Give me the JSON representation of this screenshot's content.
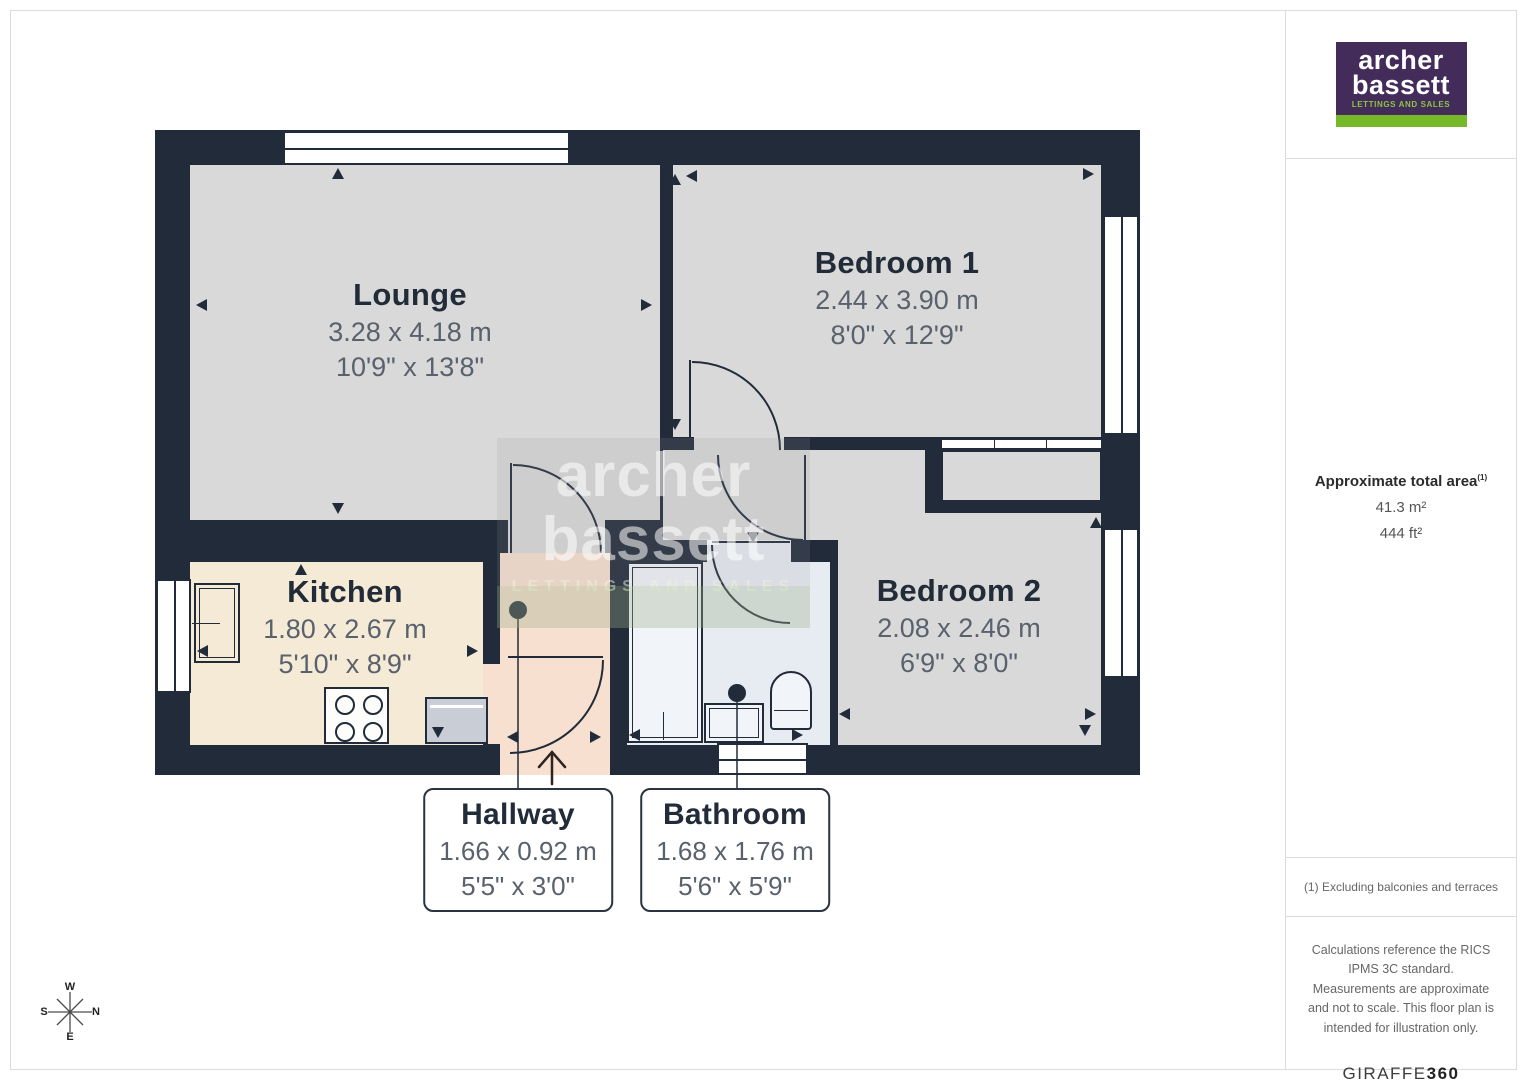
{
  "plan": {
    "rooms": [
      {
        "name": "Lounge",
        "metric": "3.28 x 4.18 m",
        "imperial": "10'9\" x 13'8\""
      },
      {
        "name": "Bedroom 1",
        "metric": "2.44 x 3.90 m",
        "imperial": "8'0\" x 12'9\""
      },
      {
        "name": "Kitchen",
        "metric": "1.80 x 2.67 m",
        "imperial": "5'10\" x 8'9\""
      },
      {
        "name": "Bedroom 2",
        "metric": "2.08 x 2.46 m",
        "imperial": "6'9\" x 8'0\""
      },
      {
        "name": "Hallway",
        "metric": "1.66 x 0.92 m",
        "imperial": "5'5\" x 3'0\""
      },
      {
        "name": "Bathroom",
        "metric": "1.68 x 1.76 m",
        "imperial": "5'6\" x 5'9\""
      }
    ],
    "watermark": {
      "line1": "archer",
      "line2": "bassett",
      "tagline": "LETTINGS AND SALES"
    },
    "compass": {
      "top": "W",
      "right": "N",
      "bottom": "E",
      "left": "S"
    }
  },
  "sidebar": {
    "logo": {
      "line1": "archer",
      "line2": "bassett",
      "tagline": "LETTINGS AND SALES"
    },
    "area": {
      "title": "Approximate total area",
      "footnote_ref": "(1)",
      "metric": "41.3 m²",
      "imperial": "444 ft²"
    },
    "footnote": "(1) Excluding balconies and terraces",
    "disclaimer": "Calculations reference the RICS IPMS 3C standard. Measurements are approximate and not to scale. This floor plan is intended for illustration only.",
    "provider": {
      "name": "GIRAFFE",
      "suffix": "360"
    }
  },
  "colors": {
    "wall": "#212b39",
    "room_gray": "#d9d9d9",
    "kitchen": "#f4ead6",
    "hallway": "#f8e0d0",
    "bathroom": "#e7ebf2",
    "logo_purple": "#432c5a",
    "logo_green": "#76b82a",
    "accent_text": "#222c39"
  }
}
